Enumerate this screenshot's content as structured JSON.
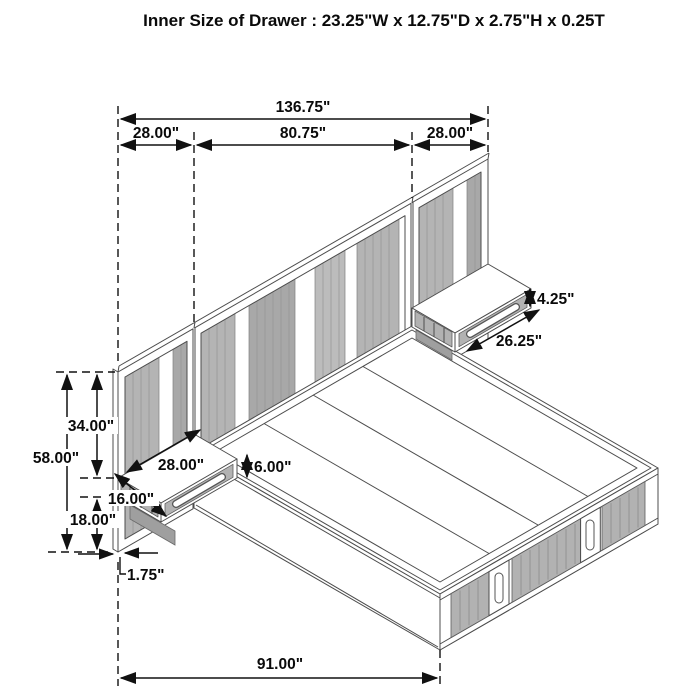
{
  "title": "Inner Size of Drawer : 23.25\"W x 12.75\"D x 2.75\"H x 0.25T",
  "dims": {
    "overall_width": "136.75\"",
    "wing_left": "28.00\"",
    "center": "80.75\"",
    "wing_right": "28.00\"",
    "panel_height": "58.00\"",
    "top_to_nightstand": "34.00\"",
    "floor_to_nightstand": "18.00\"",
    "panel_thickness": "1.75\"",
    "bed_length": "91.00\"",
    "ns_width": "28.00\"",
    "ns_depth": "16.00\"",
    "ns_height": "6.00\"",
    "drawer_front_height": "4.25\"",
    "drawer_width": "26.25\""
  },
  "colors": {
    "line": "#4d4d4d",
    "dimension": "#111111",
    "slat_gray": "#b2b2b2",
    "background": "#ffffff"
  }
}
